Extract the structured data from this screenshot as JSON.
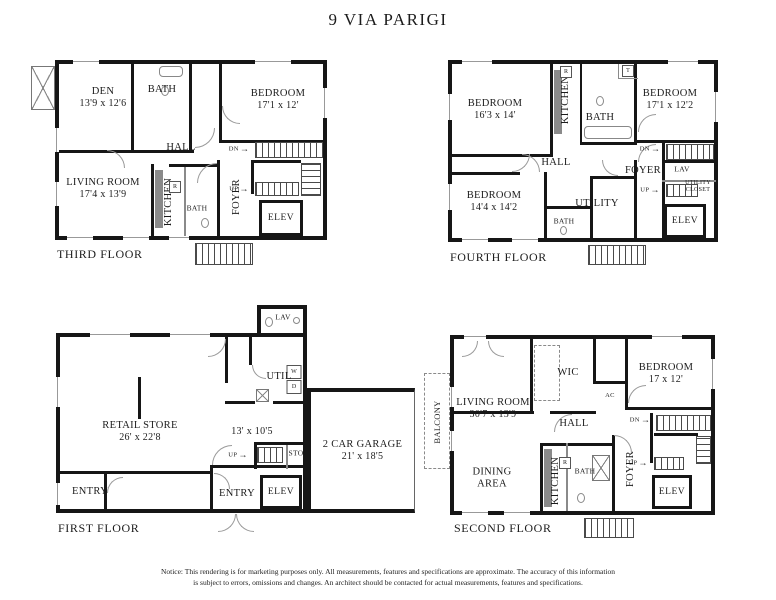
{
  "title": "9 VIA PARIGI",
  "icons": {
    "arrow_right": "→"
  },
  "notice": {
    "line1": "Notice: This rendering is for marketing purposes only. All measurements, features and specifications are approximate. The accuracy of this information",
    "line2": "is subject to errors, omissions and changes. An architect should be contacted for actual measurements, features and specifications."
  },
  "floors": {
    "third": {
      "name": "THIRD FLOOR",
      "rooms": {
        "den": {
          "label": "DEN",
          "dims": "13'9 x 12'6"
        },
        "bath_top": {
          "label": "BATH"
        },
        "bedroom": {
          "label": "BEDROOM",
          "dims": "17'1 x 12'"
        },
        "hall": {
          "label": "HALL"
        },
        "living_room": {
          "label": "LIVING ROOM",
          "dims": "17'4 x 13'9"
        },
        "kitchen": {
          "label": "KITCHEN"
        },
        "bath_bottom": {
          "label": "BATH"
        },
        "foyer": {
          "label": "FOYER"
        },
        "elev": {
          "label": "ELEV"
        }
      },
      "marks": {
        "dn": "DN",
        "up": "UP",
        "fridge": "R"
      }
    },
    "fourth": {
      "name": "FOURTH FLOOR",
      "rooms": {
        "bedroom_left": {
          "label": "BEDROOM",
          "dims": "16'3 x 14'"
        },
        "kitchen": {
          "label": "KITCHEN"
        },
        "bath_top": {
          "label": "BATH"
        },
        "bedroom_right": {
          "label": "BEDROOM",
          "dims": "17'1 x 12'2"
        },
        "hall": {
          "label": "HALL"
        },
        "bedroom_bottom": {
          "label": "BEDROOM",
          "dims": "14'4 x 14'2"
        },
        "bath_bottom": {
          "label": "BATH"
        },
        "utility": {
          "label": "UTILITY"
        },
        "foyer": {
          "label": "FOYER"
        },
        "lav": {
          "label": "LAV"
        },
        "utility_closet": {
          "label": "UTILITY CLOSET"
        },
        "elev": {
          "label": "ELEV"
        }
      },
      "marks": {
        "dn": "DN",
        "up": "UP",
        "fridge": "R",
        "toilet": "T"
      }
    },
    "first": {
      "name": "FIRST FLOOR",
      "rooms": {
        "lav": {
          "label": "LAV"
        },
        "util": {
          "label": "UTIL"
        },
        "retail": {
          "label": "RETAIL STORE",
          "dims": "26' x 22'8"
        },
        "room_13": {
          "dims": "13' x 10'5"
        },
        "sto": {
          "label": "STO"
        },
        "garage": {
          "label": "2 CAR GARAGE",
          "dims": "21' x 18'5"
        },
        "entry_left": {
          "label": "ENTRY"
        },
        "entry_center": {
          "label": "ENTRY"
        },
        "elev": {
          "label": "ELEV"
        }
      },
      "marks": {
        "up": "UP",
        "washer": "W",
        "dryer": "D"
      }
    },
    "second": {
      "name": "SECOND FLOOR",
      "rooms": {
        "balcony": {
          "label": "BALCONY"
        },
        "living_room": {
          "label": "LIVING ROOM",
          "dims": "30'7 x 13'9"
        },
        "wic": {
          "label": "WIC"
        },
        "ac": {
          "label": "AC"
        },
        "bedroom": {
          "label": "BEDROOM",
          "dims": "17 x 12'"
        },
        "hall": {
          "label": "HALL"
        },
        "dining": {
          "label": "DINING AREA"
        },
        "kitchen": {
          "label": "KITCHEN"
        },
        "bath": {
          "label": "BATH"
        },
        "foyer": {
          "label": "FOYER"
        },
        "elev": {
          "label": "ELEV"
        }
      },
      "marks": {
        "dn": "DN",
        "up": "UP",
        "fridge": "R"
      }
    }
  }
}
